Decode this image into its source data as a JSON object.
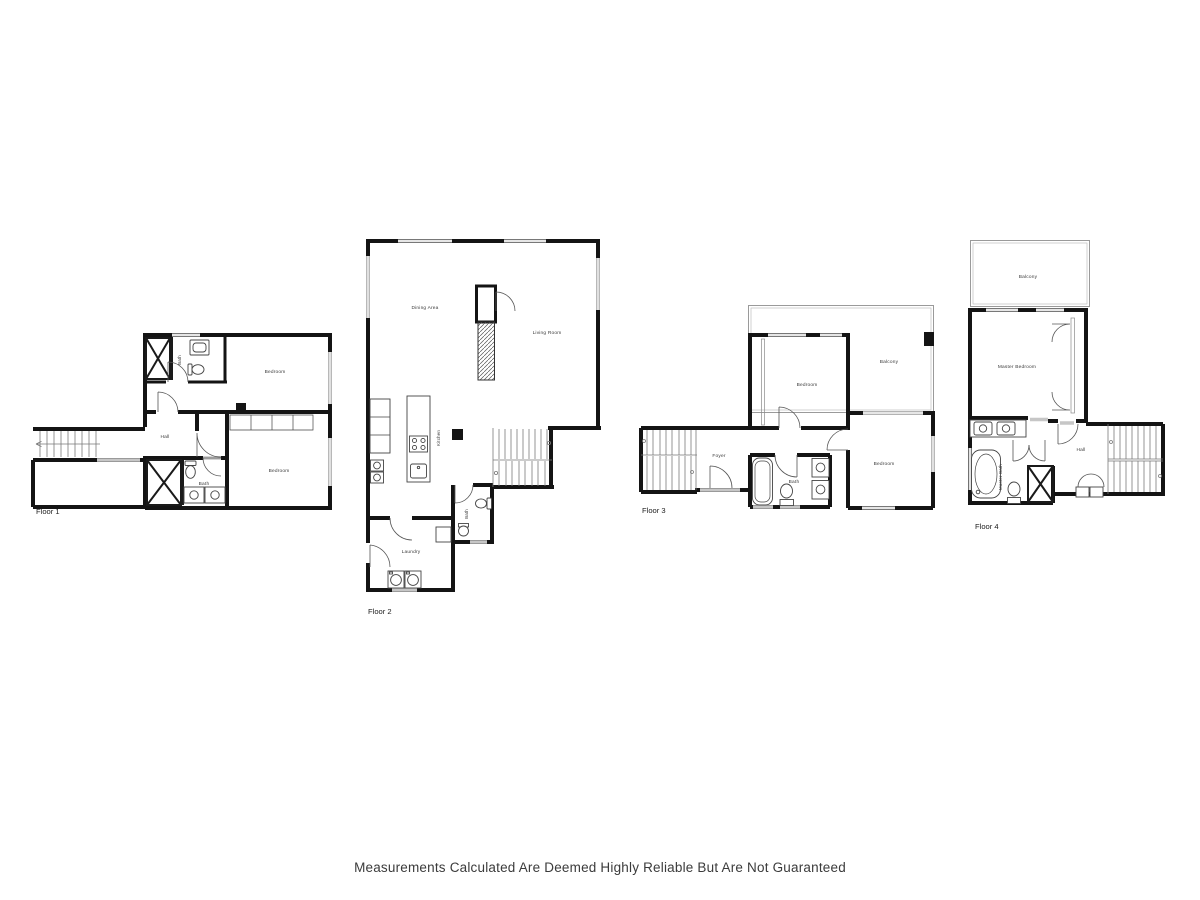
{
  "meta": {
    "wall_color": "#141414",
    "window_color": "#9a9a9a",
    "label_color": "#3a3a3a",
    "background": "#ffffff"
  },
  "disclaimer": "Measurements Calculated Are Deemed Highly Reliable But Are Not Guaranteed",
  "floors": [
    {
      "name": "Floor 1",
      "rooms": [
        {
          "label": "Bath"
        },
        {
          "label": "Bedroom"
        },
        {
          "label": "Hall"
        },
        {
          "label": "Bath"
        },
        {
          "label": "Bedroom"
        }
      ]
    },
    {
      "name": "Floor 2",
      "rooms": [
        {
          "label": "Dining Area"
        },
        {
          "label": "Living Room"
        },
        {
          "label": "Kitchen"
        },
        {
          "label": "Bath"
        },
        {
          "label": "Laundry"
        }
      ]
    },
    {
      "name": "Floor 3",
      "rooms": [
        {
          "label": "Bedroom"
        },
        {
          "label": "Balcony"
        },
        {
          "label": "Foyer"
        },
        {
          "label": "Bath"
        },
        {
          "label": "Bedroom"
        }
      ]
    },
    {
      "name": "Floor 4",
      "rooms": [
        {
          "label": "Balcony"
        },
        {
          "label": "Master Bedroom"
        },
        {
          "label": "Master Bath"
        },
        {
          "label": "Hall"
        }
      ]
    }
  ]
}
